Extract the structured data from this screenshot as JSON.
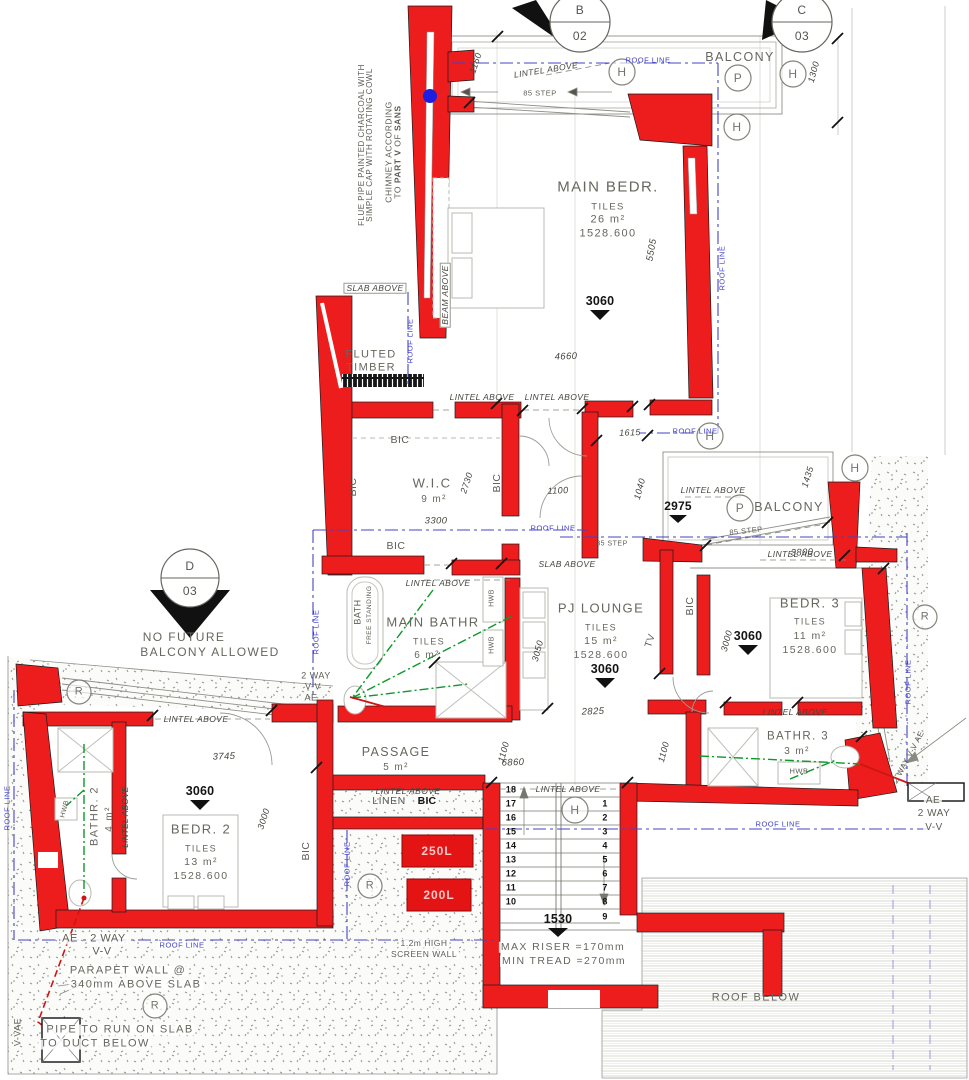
{
  "terms": {
    "lintel_above": "LINTEL ABOVE",
    "slab_above": "SLAB ABOVE",
    "beam_above": "BEAM ABOVE",
    "roof_line": "ROOF LINE",
    "bic": "BIC",
    "linen": "LINEN",
    "tv": "TV",
    "hwb": "HWB",
    "step85": "85 STEP",
    "tiles": "TILES",
    "level": "1528.600",
    "l3060": "3060",
    "balcony": "BALCONY"
  },
  "rooms": {
    "main_bedr": {
      "name": "MAIN BEDR.",
      "area": "26 m²"
    },
    "wic": {
      "name": "W.I.C",
      "area": "9 m²"
    },
    "main_bath": {
      "name": "MAIN BATHR",
      "area": "6 m²"
    },
    "pj_lounge": {
      "name": "PJ LOUNGE",
      "area": "15 m²"
    },
    "bedr3": {
      "name": "BEDR. 3",
      "area": "11 m²"
    },
    "bathr3": {
      "name": "BATHR. 3",
      "area": "3 m²"
    },
    "passage": {
      "name": "PASSAGE",
      "area": "5 m²"
    },
    "bedr2": {
      "name": "BEDR. 2",
      "area": "13 m²"
    },
    "bathr2": {
      "name": "BATHR. 2",
      "area": "4 m²"
    }
  },
  "dims": {
    "d1160": "1160",
    "d1300": "1300",
    "d5505": "5505",
    "d4660": "4660",
    "d3300": "3300",
    "d2730": "2730",
    "d1100a": "1100",
    "d1615": "1615",
    "d1040": "1040",
    "d1435": "1435",
    "d2975": "2975",
    "d3800": "3800",
    "d3000a": "3000",
    "d3050": "3050",
    "d2825": "2825",
    "d6860": "6860",
    "d1100b": "1100",
    "d3745": "3745",
    "d3000b": "3000",
    "d1100c": "1100",
    "d1530": "1530"
  },
  "markers": {
    "b": {
      "letter": "B",
      "num": "02"
    },
    "c": {
      "letter": "C",
      "num": "03"
    },
    "d": {
      "letter": "D",
      "num": "03"
    },
    "p": "P",
    "h": "H",
    "r": "R"
  },
  "stairs": {
    "left": [
      "18",
      "17",
      "16",
      "15",
      "14",
      "13",
      "12",
      "11",
      "10"
    ],
    "right": [
      "1",
      "2",
      "3",
      "4",
      "5",
      "6",
      "7",
      "8",
      "9"
    ],
    "max_riser": "MAX RISER =170mm",
    "min_tread": "MIN TREAD =270mm"
  },
  "tanks": {
    "t250": "250L",
    "t200": "200L"
  },
  "notes": {
    "chimney_l1": "CHIMNEY ACCORDING",
    "chimney_l2a": "TO ",
    "chimney_l2b": "PART V",
    "chimney_l2c": " OF ",
    "chimney_l2d": "SANS",
    "flue_l1": "FLUE PIPE PAINTED CHARCOAL WITH",
    "flue_l2": "SIMPLE CAP WITH ROTATING COWL",
    "fluted_1": "FLUTED",
    "fluted_2": "TIMBER",
    "no_future_1": "NO FUTURE",
    "no_future_2": "BALCONY ALLOWED",
    "screen_1": "1.2m HIGH",
    "screen_2": "SCREEN WALL",
    "parapet_1": "PARAPET WALL @",
    "parapet_2": "340mm ABOVE SLAB",
    "pipe_1": "PIPE TO RUN ON SLAB",
    "pipe_2": "TO DUCT BELOW",
    "roof_below": "ROOF BELOW",
    "bath_1": "BATH",
    "bath_2": "FREE STANDING",
    "ae": "AE",
    "two_way": "2 WAY",
    "vv": "V-V",
    "vvae": "V-VAE",
    "two_way_vv_ae": "2 WAY V-V AE"
  },
  "colors": {
    "wall": "#ed1c1d",
    "roofline": "#4343c8",
    "drain": "#0a9a28",
    "pipe": "#cf1414",
    "marker_dot": "#1e1ee0"
  }
}
